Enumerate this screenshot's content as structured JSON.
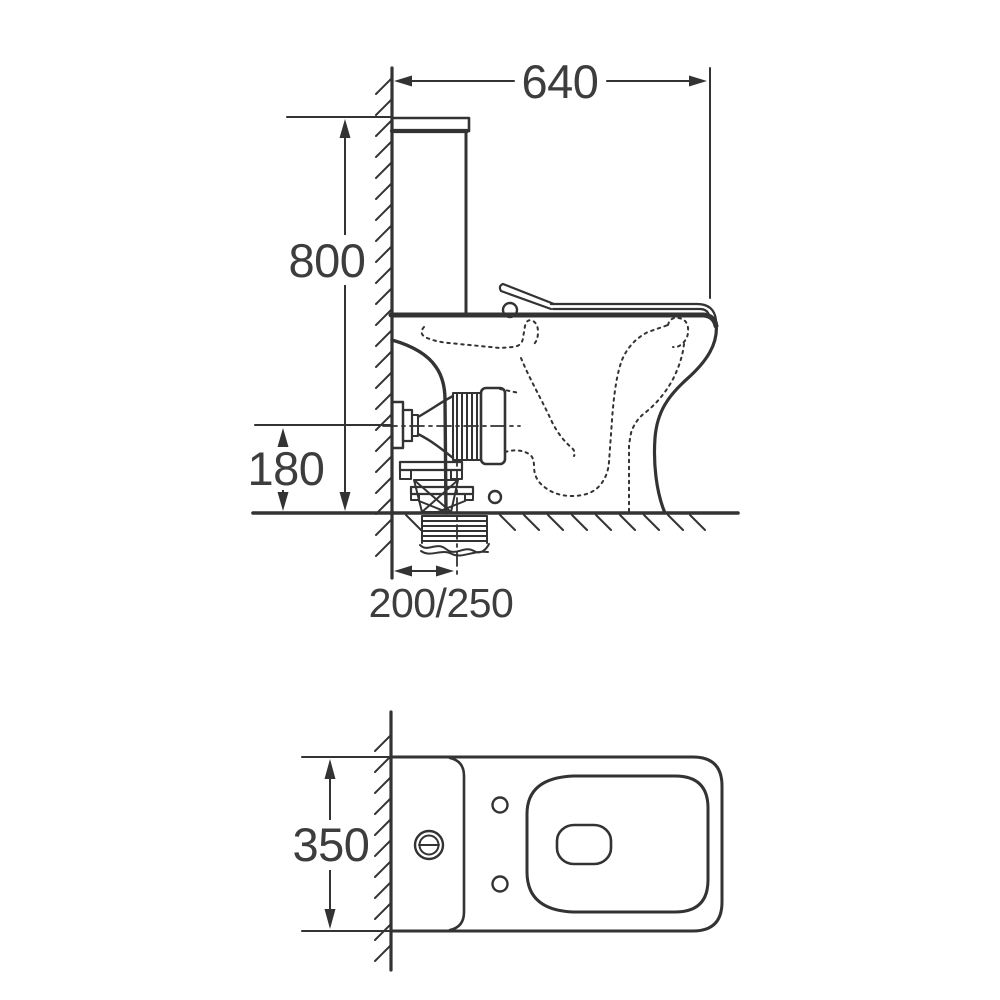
{
  "drawing": {
    "type": "technical-dimension-drawing",
    "subject": "close-coupled toilet, side elevation and plan view",
    "side_view": {
      "dim_overall_depth": "640",
      "dim_overall_height": "800",
      "dim_outlet_centre_height": "180",
      "dim_outlet_setout": "200/250"
    },
    "plan_view": {
      "dim_overall_width": "350"
    },
    "colors": {
      "line": "#333333",
      "text": "#3d3d3d",
      "background": "#ffffff"
    }
  }
}
